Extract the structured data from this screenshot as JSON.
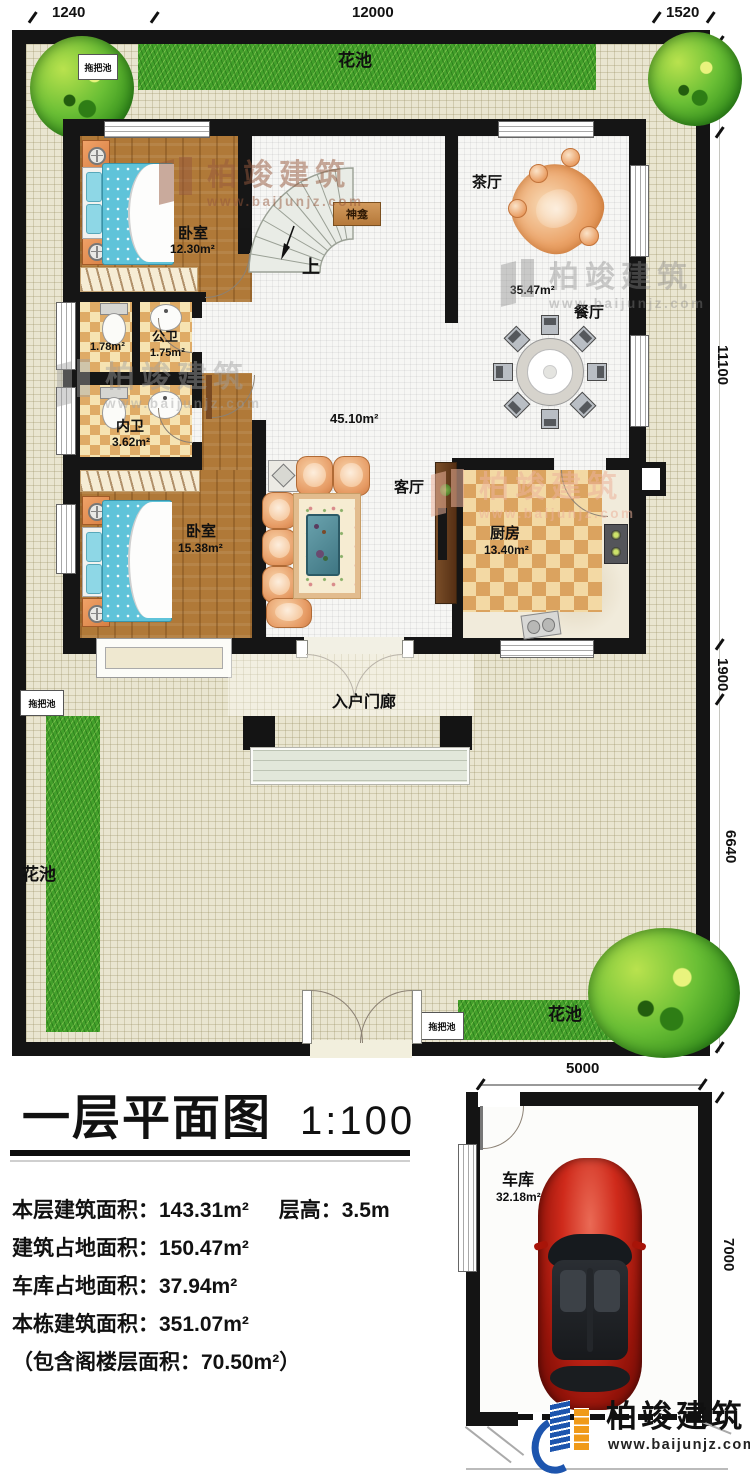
{
  "dimensions": {
    "top": [
      "1240",
      "12000",
      "1520"
    ],
    "right": [
      "2120",
      "11100",
      "1900",
      "6640"
    ],
    "garage_width": "5000",
    "garage_height": "7000"
  },
  "garden": {
    "flower_bed_top": "花池",
    "flower_bed_left": "花池",
    "flower_bed_bottom": "花池",
    "mop_pool_top": "拖把池",
    "mop_pool_left": "拖把池",
    "mop_pool_bottom": "拖把池"
  },
  "rooms": {
    "bedroom_top": {
      "name": "卧室",
      "area": "12.30m²"
    },
    "toilet_compartment": {
      "area": "1.78m²"
    },
    "public_bathroom": {
      "name": "公卫",
      "area": "1.75m²"
    },
    "private_bathroom": {
      "name": "内卫",
      "area": "3.62m²"
    },
    "bedroom_bottom": {
      "name": "卧室",
      "area": "15.38m²"
    },
    "tea_hall": {
      "name": "茶厅"
    },
    "dining_room": {
      "name": "餐厅",
      "area": "35.47m²"
    },
    "living_room": {
      "name": "客厅",
      "area": "45.10m²"
    },
    "kitchen": {
      "name": "厨房",
      "area": "13.40m²"
    },
    "shrine": {
      "name": "神龛"
    },
    "stairs_up": {
      "name": "上"
    },
    "entry_porch": {
      "name": "入户门廊"
    },
    "garage": {
      "name": "车库",
      "area": "32.18m²"
    }
  },
  "title_block": {
    "title": "一层平面图",
    "scale": "1:100",
    "stats": {
      "floor_area": "本层建筑面积：143.31m²",
      "floor_height": "层高：3.5m",
      "building_footprint": "建筑占地面积：150.47m²",
      "garage_footprint": "车库占地面积：37.94m²",
      "total_building_area": "本栋建筑面积：351.07m²",
      "attic_note": "（包含阁楼层面积：70.50m²）"
    }
  },
  "watermark": {
    "brand": "柏竣建筑",
    "url": "www.baijunjz.com"
  },
  "logo": {
    "brand": "柏竣建筑",
    "url": "www.baijunjz.com"
  }
}
